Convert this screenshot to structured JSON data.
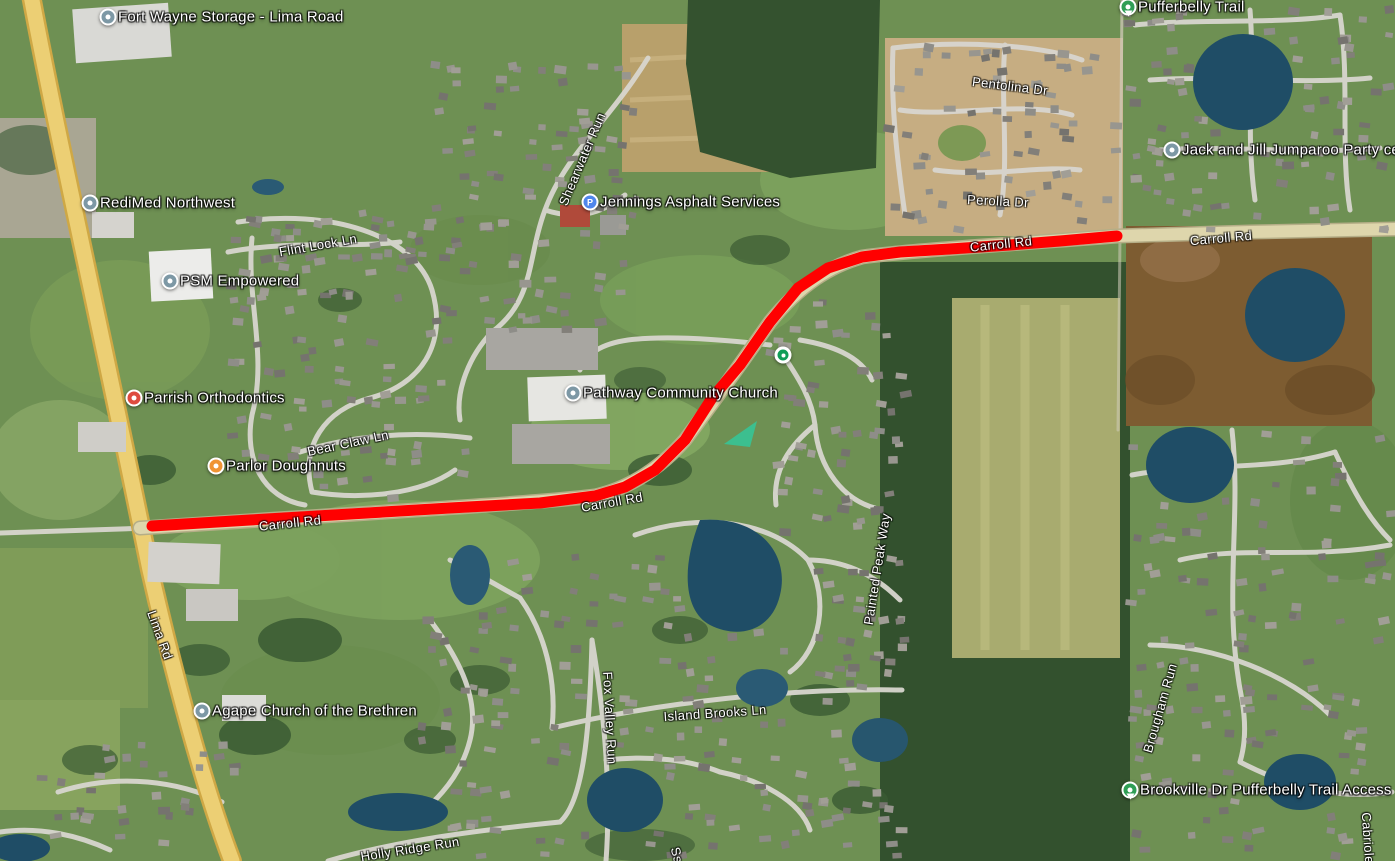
{
  "map": {
    "route": {
      "label": "Carroll Rd highlighted route",
      "color": "#ff0000",
      "width": 11,
      "points": [
        [
          152,
          526
        ],
        [
          250,
          520
        ],
        [
          350,
          514
        ],
        [
          450,
          508
        ],
        [
          540,
          503
        ],
        [
          595,
          496
        ],
        [
          625,
          487
        ],
        [
          655,
          470
        ],
        [
          685,
          440
        ],
        [
          712,
          398
        ],
        [
          740,
          365
        ],
        [
          770,
          322
        ],
        [
          798,
          288
        ],
        [
          828,
          268
        ],
        [
          862,
          257
        ],
        [
          900,
          252
        ],
        [
          950,
          249
        ],
        [
          1010,
          245
        ],
        [
          1060,
          241
        ],
        [
          1117,
          236
        ]
      ]
    },
    "markers": [
      {
        "name": "route-intersection-dot",
        "x": 783,
        "y": 355,
        "color": "#0f9d58"
      }
    ],
    "pois": [
      {
        "label": "Fort Wayne Storage - Lima Road",
        "x": 108,
        "y": 17,
        "pin": "gray",
        "icon": "place-icon"
      },
      {
        "label": "RediMed Northwest",
        "x": 90,
        "y": 203,
        "pin": "gray",
        "icon": "place-icon"
      },
      {
        "label": "PSM Empowered",
        "x": 170,
        "y": 281,
        "pin": "gray",
        "icon": "place-icon"
      },
      {
        "label": "Parrish Orthodontics",
        "x": 134,
        "y": 398,
        "pin": "red",
        "icon": "medical-icon"
      },
      {
        "label": "Parlor Doughnuts",
        "x": 216,
        "y": 466,
        "pin": "orange",
        "icon": "restaurant-icon"
      },
      {
        "label": "Jennings Asphalt Services",
        "x": 590,
        "y": 202,
        "pin": "blue",
        "icon": "p-badge-icon",
        "badge": "P"
      },
      {
        "label": "Pathway Community Church",
        "x": 573,
        "y": 393,
        "pin": "gray",
        "icon": "place-icon"
      },
      {
        "label": "Agape Church of the Brethren",
        "x": 202,
        "y": 711,
        "pin": "gray",
        "icon": "place-icon"
      },
      {
        "label": "Jack and Jill Jumparoo Party central",
        "x": 1172,
        "y": 150,
        "pin": "gray",
        "icon": "place-icon"
      },
      {
        "label": "Pufferbelly Trail",
        "x": 1128,
        "y": 7,
        "pin": "green",
        "icon": "trail-icon"
      },
      {
        "label": "Brookville Dr Pufferbelly Trail Access",
        "x": 1130,
        "y": 790,
        "pin": "green",
        "icon": "trail-icon"
      }
    ],
    "road_labels": [
      {
        "text": "Flint Lock Ln",
        "x": 318,
        "y": 245,
        "rot": -10
      },
      {
        "text": "Shearwater Run",
        "x": 582,
        "y": 159,
        "rot": -67
      },
      {
        "text": "Bear Claw Ln",
        "x": 348,
        "y": 443,
        "rot": -12
      },
      {
        "text": "Carroll Rd",
        "x": 290,
        "y": 523,
        "rot": -6
      },
      {
        "text": "Carroll Rd",
        "x": 612,
        "y": 502,
        "rot": -10
      },
      {
        "text": "Carroll Rd",
        "x": 1001,
        "y": 244,
        "rot": -6
      },
      {
        "text": "Carroll Rd",
        "x": 1221,
        "y": 238,
        "rot": -5
      },
      {
        "text": "Lima Rd",
        "x": 160,
        "y": 635,
        "rot": 70
      },
      {
        "text": "Pentolina Dr",
        "x": 1010,
        "y": 86,
        "rot": 7
      },
      {
        "text": "Perolla Dr",
        "x": 998,
        "y": 201,
        "rot": 3
      },
      {
        "text": "Painted Peak Way",
        "x": 877,
        "y": 569,
        "rot": -81
      },
      {
        "text": "Fox Valley Run",
        "x": 610,
        "y": 718,
        "rot": 87
      },
      {
        "text": "Island Brooks Ln",
        "x": 715,
        "y": 713,
        "rot": -4
      },
      {
        "text": "Holly Ridge Run",
        "x": 410,
        "y": 849,
        "rot": -9
      },
      {
        "text": "Brougham Run",
        "x": 1160,
        "y": 708,
        "rot": -74
      },
      {
        "text": "Cabriole",
        "x": 1368,
        "y": 838,
        "rot": 86
      },
      {
        "text": "Ss",
        "x": 677,
        "y": 855,
        "rot": 75
      }
    ],
    "colors": {
      "route": "#ff0000",
      "highway": "#eccf74",
      "road_major": "#ded6ac",
      "road_minor": "#d8d6cf",
      "pin_gray": "#7d98a5",
      "pin_red": "#de4b3f",
      "pin_orange": "#f09434",
      "pin_blue": "#4f86ec",
      "pin_green": "#2f9e55",
      "marker_green": "#0f9d58"
    }
  }
}
